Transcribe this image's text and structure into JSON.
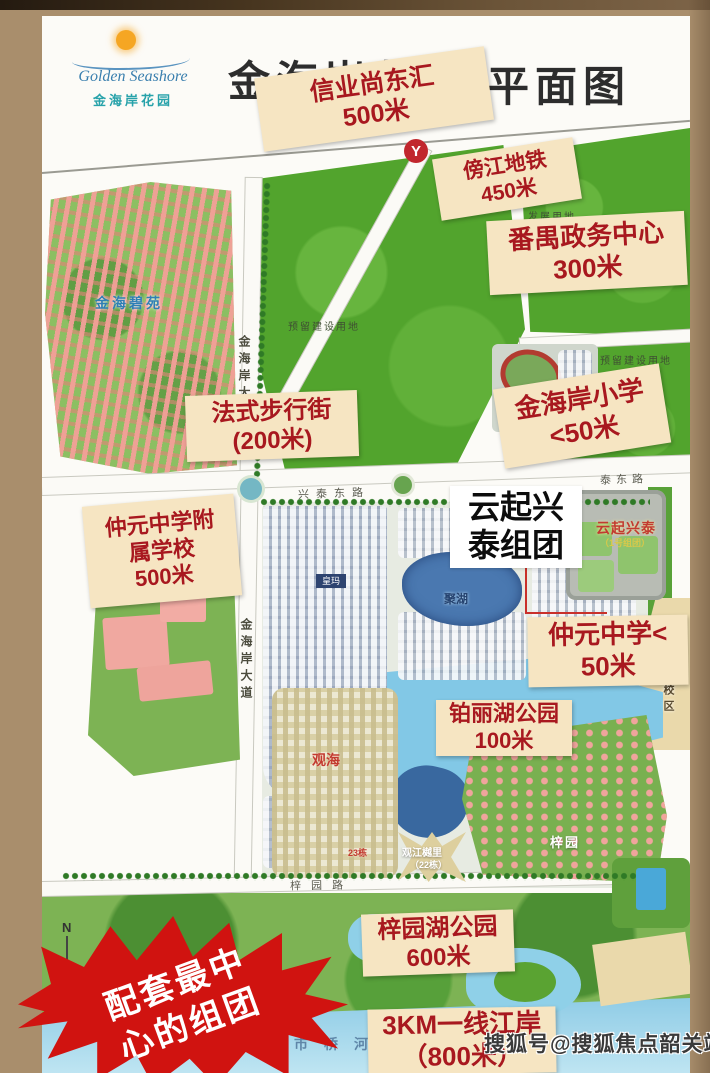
{
  "header": {
    "logo_en": "Golden Seashore",
    "logo_cn": "金海岸花园",
    "title_left": "金海岸花",
    "title_right": "平面图"
  },
  "poi_labels": {
    "xinye": {
      "line1": "信业尚东汇",
      "line2": "500米"
    },
    "bangjiang": {
      "line1": "傍江地铁",
      "line2": "450米"
    },
    "panyu": {
      "line1": "番禺政务中心",
      "line2": "300米"
    },
    "fashi": {
      "line1": "法式步行街",
      "line2": "(200米)"
    },
    "xiaoxue": {
      "line1": "金海岸小学",
      "line2": "<50米"
    },
    "fuxiao": {
      "line1": "仲元中学附",
      "line2": "属学校",
      "line3": "500米"
    },
    "yunqi": {
      "line1": "云起兴",
      "line2": "泰组团"
    },
    "zhongyuan": {
      "line1": "仲元中学<",
      "line2": "50米"
    },
    "bolihu": {
      "line1": "铂丽湖公园",
      "line2": "100米"
    },
    "ziyuanhu": {
      "line1": "梓园湖公园",
      "line2": "600米"
    },
    "jiangan": {
      "line1": "3KM一线江岸",
      "line2": "（800米）"
    }
  },
  "burst": {
    "line1": "配套最中",
    "line2": "心的组团"
  },
  "map_texts": {
    "estate_name": "金海碧苑",
    "reserved_land_1": "预留建设用地",
    "development_land": "发展用地",
    "reserved_land_2": "预留建设用地",
    "road_jinhaian_1": "金海岸大道",
    "road_jinhaian_2": "金海岸大道",
    "road_xingtai": "兴泰东路",
    "road_taidong": "泰东路",
    "yunqi_map": "云起兴泰",
    "yunqi_map_sub": "（1号组团）",
    "lake_juhu": "聚湖",
    "huangma": "皇玛",
    "campus_area": "一校区",
    "guanhai": "观海",
    "block23": "23栋",
    "guanjiang": "观江樾里",
    "block22": "（22栋）",
    "ziyuan": "梓园",
    "road_ziyuan": "梓园路",
    "river_shiqiao": "市桥河",
    "compass": "N"
  },
  "icons": {
    "metro_glyph": "Y"
  },
  "watermark": "搜狐号@搜狐焦点韶关站",
  "colors": {
    "label_bg": "#f6e5c2",
    "label_text": "#a8181f",
    "burst_red": "#d01310",
    "frame_brown": "#a98e6c",
    "metro_red": "#c1272d",
    "field_green": "#52a42d",
    "water_blue": "#82c8e6"
  }
}
